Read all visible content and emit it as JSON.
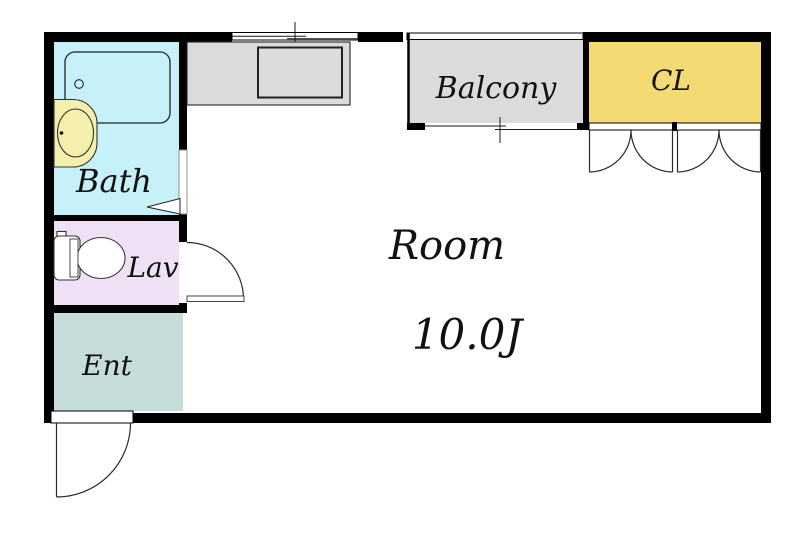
{
  "plan": {
    "type": "apartment-floor-plan",
    "rooms": {
      "bath": {
        "label": "Bath",
        "color": "#c6f1f8"
      },
      "lav": {
        "label": "Lav",
        "color": "#f0e0f5"
      },
      "ent": {
        "label": "Ent",
        "color": "#c5dcda"
      },
      "balcony": {
        "label": "Balcony",
        "color": "#dbdbdb"
      },
      "closet": {
        "label": "CL",
        "color": "#f3da72"
      },
      "main_room": {
        "label": "Room",
        "size_label": "10.0J"
      }
    },
    "fixtures": {
      "bathtub": "bathtub-icon",
      "washbasin": "washbasin-icon",
      "toilet": "toilet-icon",
      "kitchen_counter": "kitchen-counter-sink-icon"
    },
    "colors": {
      "wall": "#000000",
      "counter": "#dbdbdb",
      "basin": "#f5efae",
      "label_text": "#111111"
    }
  }
}
